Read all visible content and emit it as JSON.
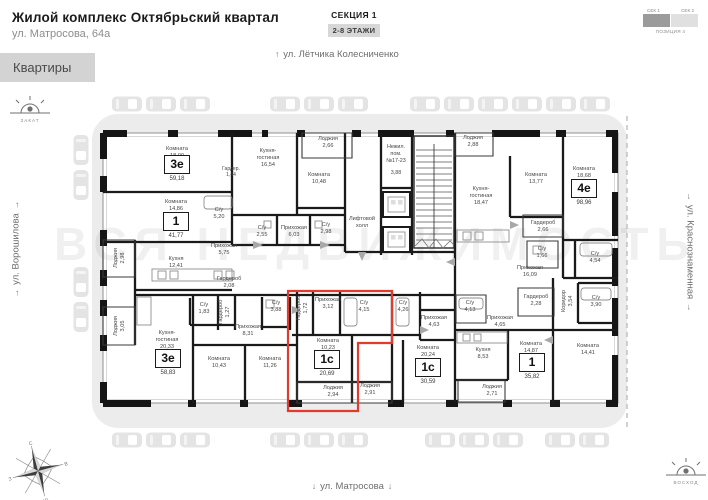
{
  "header": {
    "title": "Жилой комплекс Октябрьский квартал",
    "address": "ул. Матросова, 64а"
  },
  "section": {
    "name": "СЕКЦИЯ 1",
    "floors": "2-8 ЭТАЖИ"
  },
  "scheme": {
    "sec1": "СЕК 1",
    "sec2": "СЕК 2",
    "position": "ПОЗИЦИЯ 4"
  },
  "tabs": {
    "apartments": "Квартиры"
  },
  "streets": {
    "top": {
      "arrow": "↑",
      "name": "ул. Лётчика Колесниченко"
    },
    "bottom": {
      "arrow": "↓",
      "name": "ул. Матросова"
    },
    "left": {
      "arrow": "→",
      "name": "ул. Ворошилова"
    },
    "right": {
      "arrow": "→",
      "name": "ул. Краснознаменная"
    }
  },
  "sun": {
    "sunset": "ЗАКАТ",
    "sunrise": "ВОСХОД"
  },
  "compass": {
    "n": "С",
    "e": "В",
    "s": "Ю",
    "w": "З"
  },
  "watermark": "ВСЯ НЕДВИЖИМОСТЬ",
  "plan": {
    "selected_apartment": {
      "type": "1с",
      "area": "20,69"
    },
    "nonres": {
      "l1": "Нежил.",
      "l2": "пом.",
      "l3": "№17-23",
      "area": "3,88"
    },
    "apartments": [
      {
        "type": "3е",
        "area": "59,18",
        "x": 177,
        "y": 155
      },
      {
        "type": "1",
        "area": "41,77",
        "x": 176,
        "y": 212
      },
      {
        "type": "4е",
        "area": "98,96",
        "x": 584,
        "y": 179
      },
      {
        "type": "3е",
        "area": "58,83",
        "x": 168,
        "y": 349
      },
      {
        "type": "1с",
        "area": "20,69",
        "x": 327,
        "y": 350,
        "selected": true
      },
      {
        "type": "1с",
        "area": "30,59",
        "x": 428,
        "y": 358
      },
      {
        "type": "1",
        "area": "35,82",
        "x": 532,
        "y": 353
      }
    ],
    "rooms": [
      {
        "n": "Комната",
        "a": "18,00",
        "x": 177,
        "y": 146
      },
      {
        "n": "Кухня-",
        "n2": "гостиная",
        "a": "16,54",
        "x": 268,
        "y": 148
      },
      {
        "n": "Гардер.",
        "a": "1,44",
        "x": 231,
        "y": 166,
        "sm": 1
      },
      {
        "n": "Лоджия",
        "a": "2,66",
        "x": 328,
        "y": 136
      },
      {
        "n": "Комната",
        "a": "10,48",
        "x": 319,
        "y": 172
      },
      {
        "n": "Лоджия",
        "a": "2,88",
        "x": 473,
        "y": 135
      },
      {
        "n": "Кухня-",
        "n2": "гостиная",
        "a": "18,47",
        "x": 481,
        "y": 186
      },
      {
        "n": "Комната",
        "a": "13,77",
        "x": 536,
        "y": 172
      },
      {
        "n": "Комната",
        "a": "18,68",
        "x": 584,
        "y": 166
      },
      {
        "n": "Комната",
        "a": "14,86",
        "x": 176,
        "y": 199
      },
      {
        "n": "С/у",
        "a": "5,20",
        "x": 219,
        "y": 207
      },
      {
        "n": "С/у",
        "a": "2,55",
        "x": 262,
        "y": 225
      },
      {
        "n": "Прихожая",
        "a": "6,03",
        "x": 294,
        "y": 225
      },
      {
        "n": "С/у",
        "a": "2,98",
        "x": 326,
        "y": 222
      },
      {
        "n": "Лифтовой",
        "n2": "холл",
        "x": 362,
        "y": 216
      },
      {
        "n": "Гардероб",
        "a": "2,66",
        "x": 543,
        "y": 220
      },
      {
        "n": "С/у",
        "a": "1,66",
        "x": 542,
        "y": 246
      },
      {
        "n": "С/у",
        "a": "4,54",
        "x": 595,
        "y": 251
      },
      {
        "n": "Прихожая",
        "a": "16,09",
        "x": 530,
        "y": 265
      },
      {
        "n": "Лоджия",
        "a": "2,98",
        "x": 120,
        "y": 258,
        "v": 1
      },
      {
        "n": "Кухня",
        "a": "12,41",
        "x": 176,
        "y": 256
      },
      {
        "n": "Прихожая",
        "a": "5,75",
        "x": 224,
        "y": 243
      },
      {
        "n": "Гардероб",
        "a": "2,08",
        "x": 229,
        "y": 276
      },
      {
        "n": "Лоджия",
        "a": "3,05",
        "x": 120,
        "y": 326,
        "v": 1
      },
      {
        "n": "С/у",
        "a": "1,83",
        "x": 204,
        "y": 302
      },
      {
        "n": "Гардероб",
        "a": "1,27",
        "x": 225,
        "y": 312,
        "v": 1
      },
      {
        "n": "Прихожая",
        "a": "8,31",
        "x": 248,
        "y": 324
      },
      {
        "n": "С/у",
        "a": "3,88",
        "x": 276,
        "y": 300
      },
      {
        "n": "Гардероб",
        "a": "1,72",
        "x": 303,
        "y": 308,
        "v": 1
      },
      {
        "n": "Прихожая",
        "a": "3,12",
        "x": 328,
        "y": 297
      },
      {
        "n": "С/у",
        "a": "4,15",
        "x": 364,
        "y": 300
      },
      {
        "n": "С/у",
        "a": "4,26",
        "x": 403,
        "y": 300
      },
      {
        "n": "Прихожая",
        "a": "4,63",
        "x": 434,
        "y": 315
      },
      {
        "n": "С/у",
        "a": "4,13",
        "x": 470,
        "y": 300
      },
      {
        "n": "Прихожая",
        "a": "4,65",
        "x": 500,
        "y": 315
      },
      {
        "n": "Гардероб",
        "a": "2,28",
        "x": 536,
        "y": 294
      },
      {
        "n": "Коридор",
        "a": "3,54",
        "x": 568,
        "y": 301,
        "v": 1
      },
      {
        "n": "С/у",
        "a": "3,90",
        "x": 596,
        "y": 295
      },
      {
        "n": "Кухня-",
        "n2": "гостиная",
        "a": "20,33",
        "x": 167,
        "y": 330
      },
      {
        "n": "Комната",
        "a": "10,43",
        "x": 219,
        "y": 356
      },
      {
        "n": "Комната",
        "a": "11,26",
        "x": 270,
        "y": 356
      },
      {
        "n": "Комната",
        "a": "10,23",
        "x": 328,
        "y": 338
      },
      {
        "n": "Лоджия",
        "a": "2,94",
        "x": 333,
        "y": 385
      },
      {
        "n": "Лоджия",
        "a": "2,91",
        "x": 370,
        "y": 383
      },
      {
        "n": "Комната",
        "a": "20,24",
        "x": 428,
        "y": 345
      },
      {
        "n": "Кухня",
        "a": "8,53",
        "x": 483,
        "y": 347
      },
      {
        "n": "Комната",
        "a": "14,87",
        "x": 531,
        "y": 341
      },
      {
        "n": "Комната",
        "a": "14,41",
        "x": 588,
        "y": 343
      },
      {
        "n": "Лоджия",
        "a": "2,71",
        "x": 492,
        "y": 384
      }
    ]
  }
}
